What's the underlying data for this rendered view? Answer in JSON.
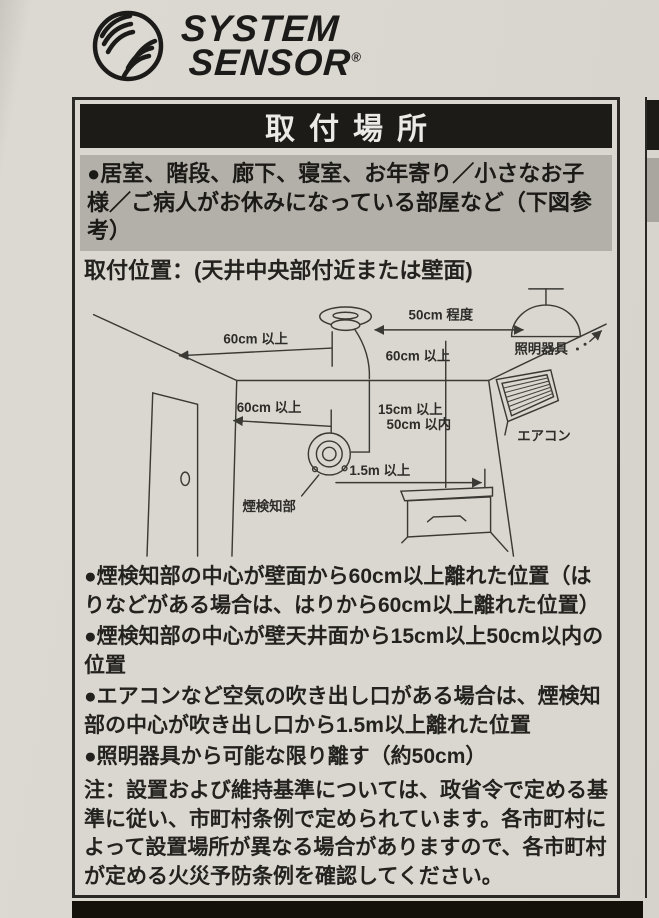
{
  "brand": {
    "name_line1": "SYSTEM",
    "name_line2": "SENSOR",
    "reg": "®"
  },
  "section": {
    "title": "取付場所",
    "rooms": "●居室、階段、廊下、寝室、お年寄り／小さなお子様／ご病人がお休みになっている部屋など（下図参考）",
    "position": "取付位置：(天井中央部付近または壁面)",
    "bullets": [
      "●煙検知部の中心が壁面から60cm以上離れた位置（はりなどがある場合は、はりから60cm以上離れた位置）",
      "●煙検知部の中心が壁天井面から15cm以上50cm以内の位置",
      "●エアコンなど空気の吹き出し口がある場合は、煙検知部の中心が吹き出し口から1.5m以上離れた位置",
      "●照明器具から可能な限り離す（約50cm）"
    ],
    "note": "注：設置および維持基準については、政省令で定める基準に従い、市町村条例で定められています。各市町村によって設置場所が異なる場合がありますので、各市町村が定める火災予防条例を確認してください。"
  },
  "diagram": {
    "label_ceiling_gap": "60cm 以上",
    "label_lamp_gap": "50cm 程度",
    "label_lighting": "照明器具",
    "label_wall_offset": "60cm 以上",
    "label_wall_gap": "60cm 以上",
    "label_range_line1": "15cm 以上",
    "label_range_line2": "50cm 以内",
    "label_aircon": "エアコン",
    "label_aircon_gap": "1.5m 以上",
    "label_detector": "煙検知部"
  },
  "colors": {
    "paper": "#dad7d0",
    "header_bg": "#1d1b18",
    "header_text": "#eceae5",
    "gray_box_bg": "#b3b0aa",
    "ink": "#24221e"
  }
}
